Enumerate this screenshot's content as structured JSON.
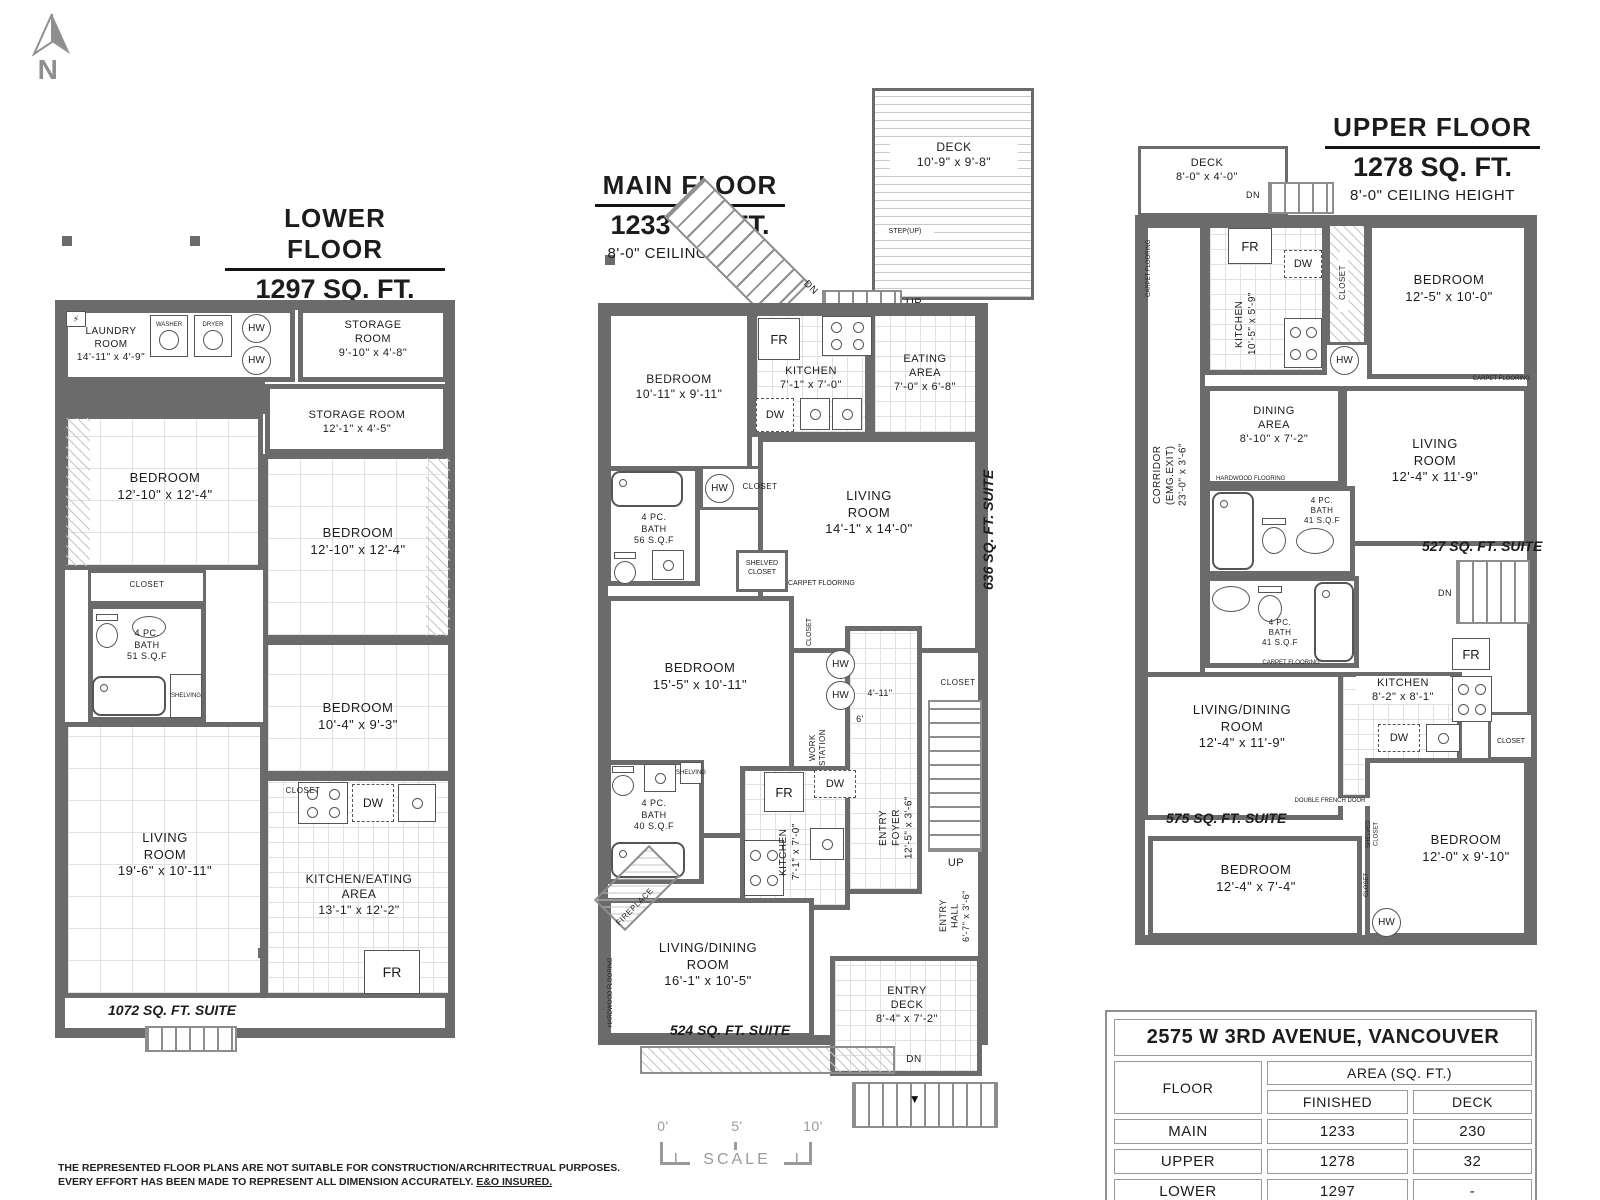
{
  "north": {
    "letter": "N"
  },
  "labels": {
    "closet": "CLOSET",
    "shelved_closet": "SHELVED\nCLOSET",
    "shelving": "SHELVING",
    "washer": "WASHER",
    "dryer": "DRYER",
    "hw": "HW",
    "fr": "FR",
    "dw": "DW",
    "up": "UP",
    "dn": "DN",
    "step_up": "STEP(UP)",
    "fireplace": "FIREPLACE",
    "carpet": "CARPET FLOORING",
    "hardwood": "HARDWOOD FLOORING",
    "double_french_door": "DOUBLE FRENCH DOOR",
    "work_station": "WORK\nSTATION",
    "elec": "⚡",
    "down_arrow": "▼"
  },
  "lower": {
    "title": "LOWER FLOOR",
    "area": "1297 SQ. FT.",
    "ceiling": "7'-0\" CEILING HEIGHT",
    "suite": "1072 SQ. FT. SUITE",
    "laundry": "LAUNDRY\nROOM\n14'-11\" x 4'-9\"",
    "storage1": "STORAGE\nROOM\n9'-10\" x 4'-8\"",
    "storage2": "STORAGE ROOM\n12'-1\" x 4'-5\"",
    "bedroom1": "BEDROOM\n12'-10\" x 12'-4\"",
    "bedroom2": "BEDROOM\n12'-10\" x 12'-4\"",
    "bedroom3": "BEDROOM\n10'-4\" x 9'-3\"",
    "bath": "4 PC.\nBATH\n51 S.Q.F",
    "living": "LIVING\nROOM\n19'-6\" x 10'-11\"",
    "kitchen": "KITCHEN/EATING\nAREA\n13'-1\" x 12'-2\""
  },
  "main": {
    "title": "MAIN FLOOR",
    "area": "1233 SQ. FT.",
    "ceiling": "8'-0\" CEILING HEIGHT",
    "deck": "DECK\n10'-9\" x 9'-8\"",
    "bedroom1": "BEDROOM\n10'-11\" x 9'-11\"",
    "kitchen1": "KITCHEN\n7'-1\" x 7'-0\"",
    "eating": "EATING\nAREA\n7'-0\" x 6'-8\"",
    "bath56": "4 PC.\nBATH\n56 S.Q.F",
    "living": "LIVING\nROOM\n14'-1\" x 14'-0\"",
    "suite636": "636 SQ. FT. SUITE",
    "bedroom2": "BEDROOM\n15'-5\" x 10'-11\"",
    "dim1": "4'-11\"",
    "dim2": "6'",
    "bath40": "4 PC.\nBATH\n40 S.Q.F",
    "kitchen2": "KITCHEN\n7'-1\" x 7'-0\"",
    "entry_foyer": "ENTRY\nFOYER\n12'-5\" x 3'-6\"",
    "entry_hall": "ENTRY\nHALL\n6'-7\" x 3'-6\"",
    "livdin": "LIVING/DINING\nROOM\n16'-1\" x 10'-5\"",
    "suite524": "524 SQ. FT. SUITE",
    "entry_deck": "ENTRY\nDECK\n8'-4\" x 7'-2\""
  },
  "upper": {
    "title": "UPPER FLOOR",
    "area": "1278 SQ. FT.",
    "ceiling": "8'-0\" CEILING HEIGHT",
    "deck": "DECK\n8'-0\" x 4'-0\"",
    "kitchen1": "KITCHEN\n10'-5\" x 5'-9\"",
    "bedroom1": "BEDROOM\n12'-5\" x 10'-0\"",
    "corridor": "CORRIDOR\n(EMG.EXIT)\n23'-0\" x 3'-6\"",
    "dining": "DINING\nAREA\n8'-10\" x 7'-2\"",
    "living": "LIVING\nROOM\n12'-4\" x 11'-9\"",
    "bath1": "4 PC.\nBATH\n41 S.Q.F",
    "suite527": "527 SQ. FT. SUITE",
    "bath2": "4 PC.\nBATH\n41 S.Q.F",
    "kitchen2": "KITCHEN\n8'-2\" x 8'-1\"",
    "livdin": "LIVING/DINING\nROOM\n12'-4\" x 11'-9\"",
    "suite575": "575 SQ. FT. SUITE",
    "bedroom2": "BEDROOM\n12'-4\" x 7'-4\"",
    "bedroom3": "BEDROOM\n12'-0\" x 9'-10\""
  },
  "scale_bar": {
    "t0": "0'",
    "t5": "5'",
    "t10": "10'",
    "label": "SCALE"
  },
  "info_table": {
    "title": "2575 W 3RD AVENUE, VANCOUVER",
    "floor_header": "FLOOR",
    "area_header": "AREA (SQ. FT.)",
    "finished_header": "FINISHED",
    "deck_header": "DECK",
    "rows": [
      {
        "floor": "MAIN",
        "finished": "1233",
        "deck": "230"
      },
      {
        "floor": "UPPER",
        "finished": "1278",
        "deck": "32"
      },
      {
        "floor": "LOWER",
        "finished": "1297",
        "deck": "-"
      }
    ],
    "total": {
      "floor": "TOTAL",
      "finished": "3808",
      "deck": "262"
    }
  },
  "disclaimer": {
    "line1": "THE REPRESENTED FLOOR PLANS ARE NOT SUITABLE FOR CONSTRUCTION/ARCHRITECTRUAL PURPOSES.",
    "line2": "EVERY EFFORT HAS BEEN MADE TO REPRESENT ALL DIMENSION ACCURATELY.",
    "line2_underlined": "E&O INSURED."
  },
  "colors": {
    "wall": "#6b6b6b",
    "muted": "#9a9a9a"
  }
}
